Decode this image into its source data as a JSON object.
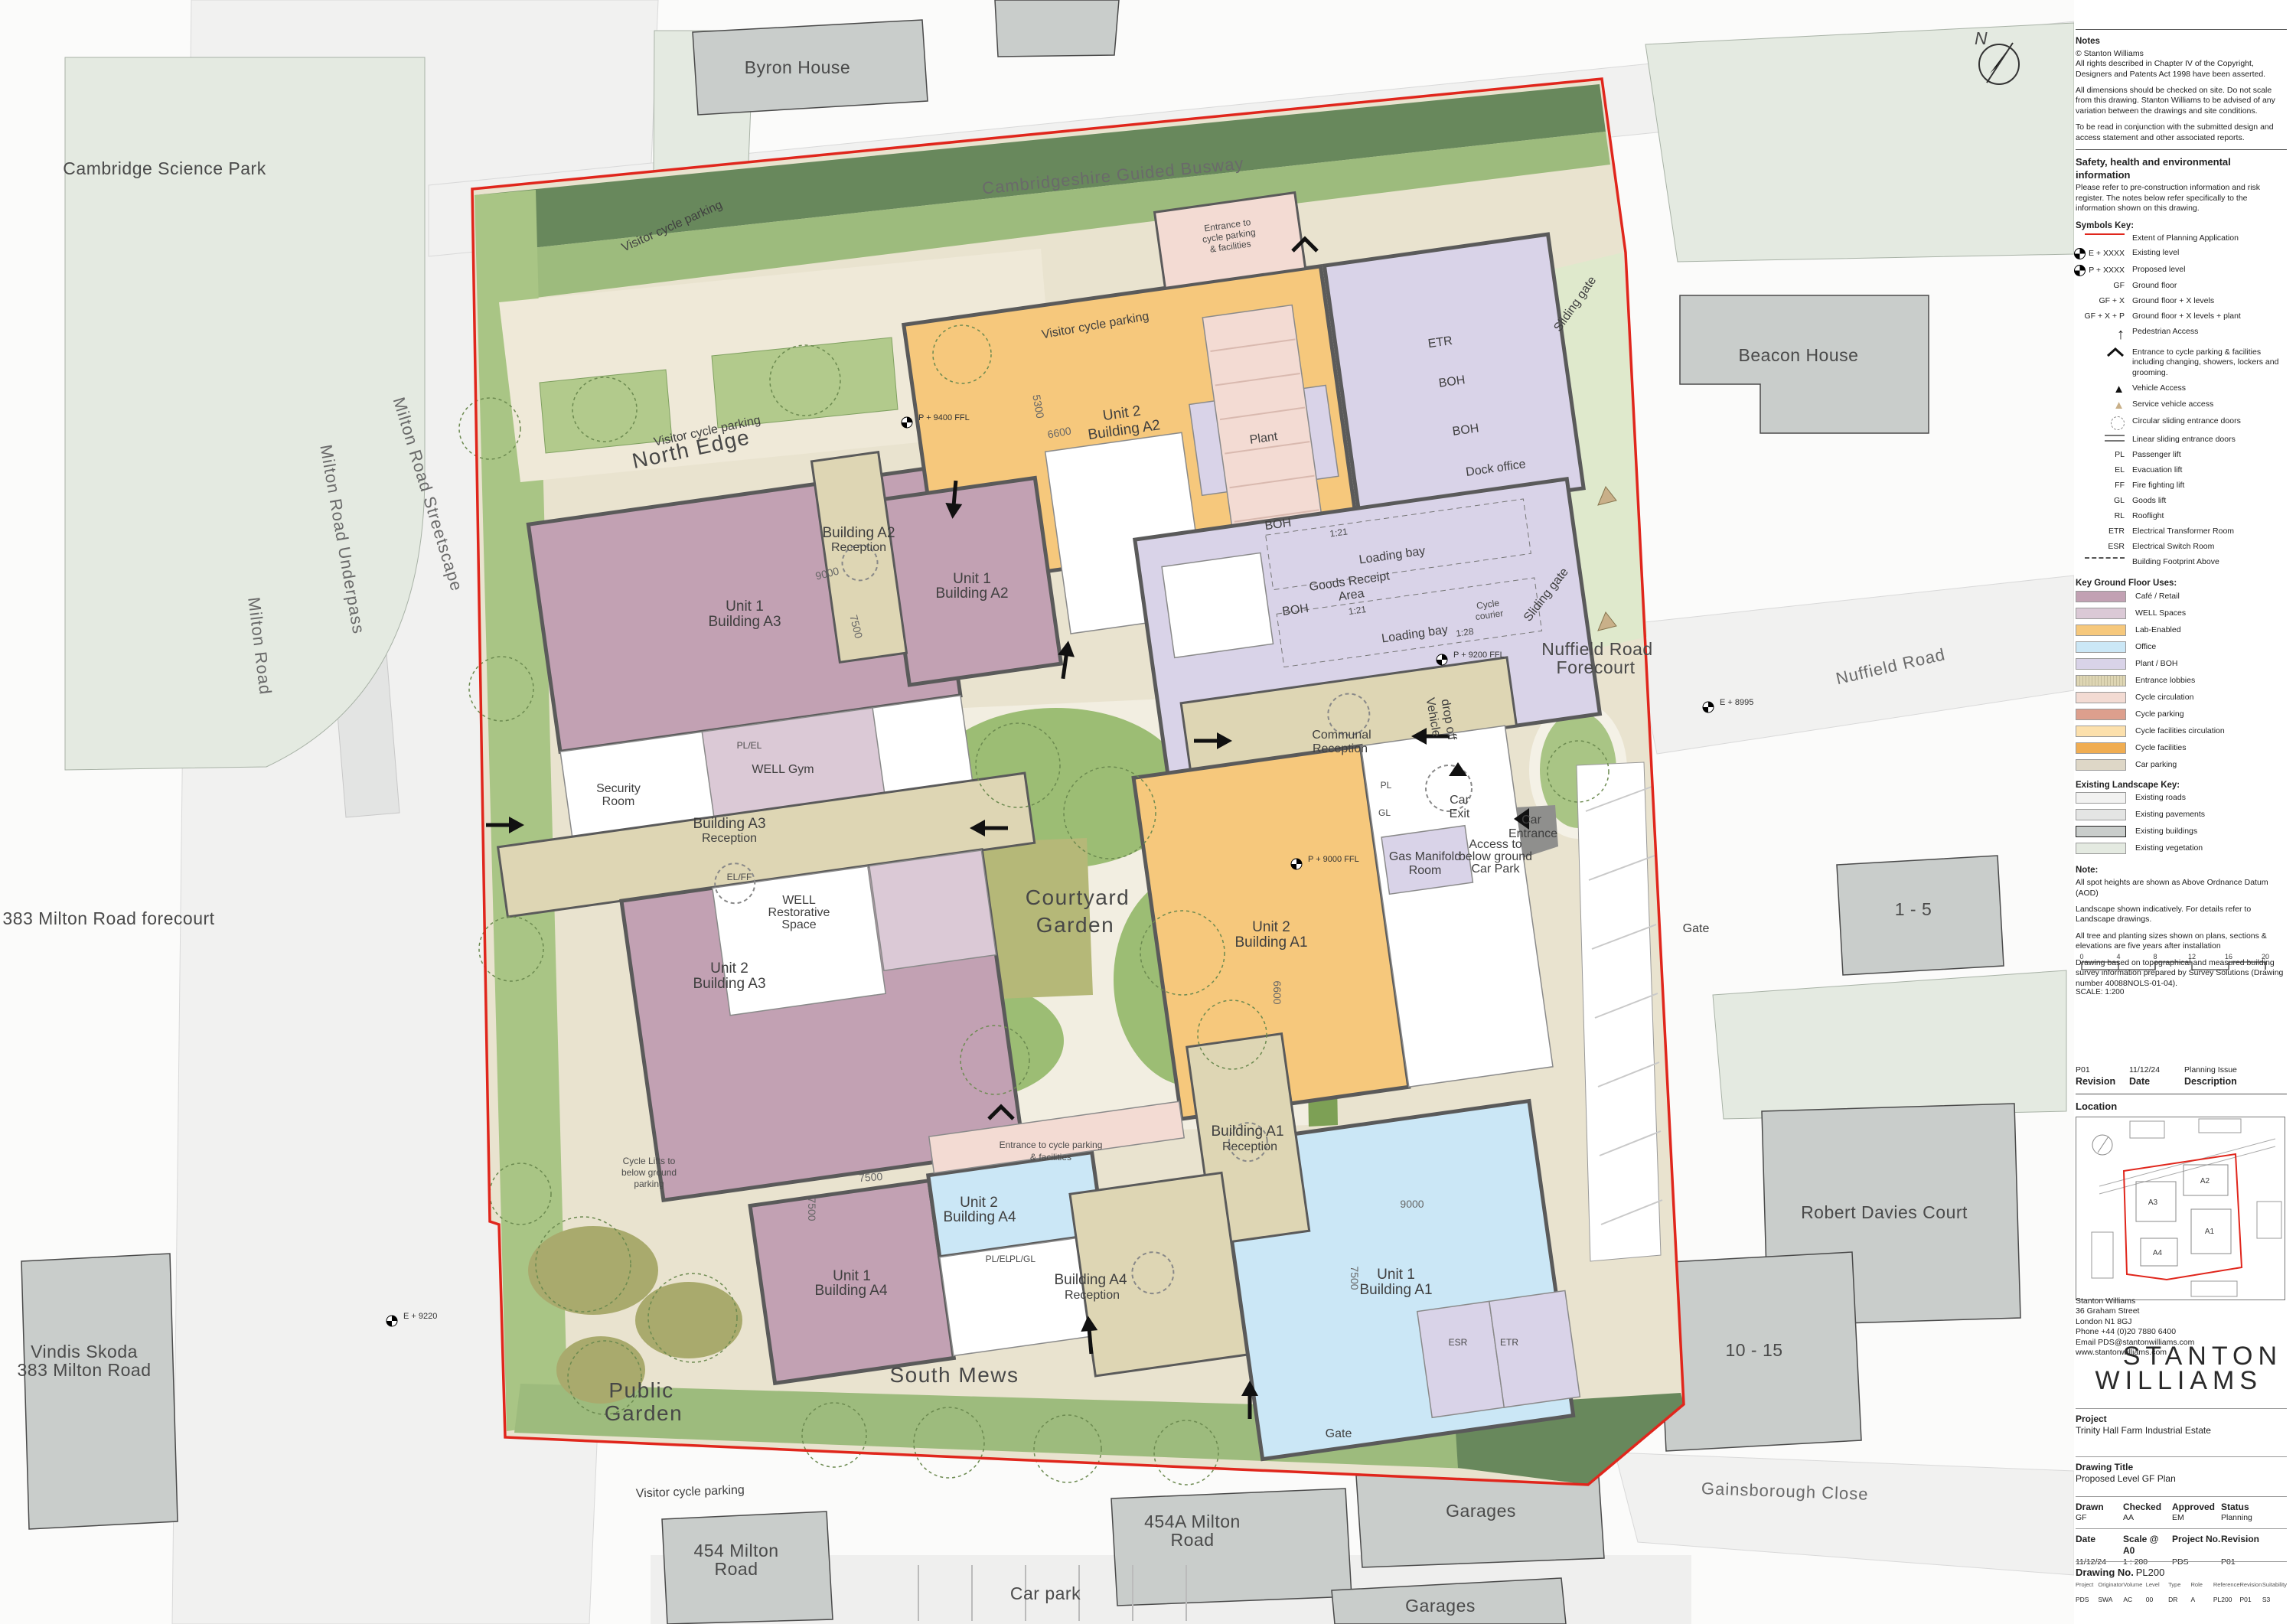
{
  "plan": {
    "labels": {
      "cambridge_science_park": "Cambridge Science Park",
      "byron_house": "Byron House",
      "guided_busway": "Cambridgeshire Guided Busway",
      "beacon_house": "Beacon House",
      "nuffield_road": "Nuffield Road",
      "one_to_five": "1 - 5",
      "robert_davies_court": "Robert Davies Court",
      "ten_to_fifteen": "10 - 15",
      "gainsborough_close": "Gainsborough Close",
      "garages": "Garages",
      "car_park": "Car park",
      "r454_1": "454 Milton",
      "r454_2": "Road",
      "r454a_1": "454A Milton",
      "r454a_2": "Road",
      "vindis_1": "Vindis Skoda",
      "vindis_2": "383 Milton Road",
      "forecourt383": "383 Milton Road forecourt",
      "milton_road": "Milton Road",
      "milton_underpass": "Milton Road Underpass",
      "milton_streetscape": "Milton Road Streetscape",
      "north_edge": "North Edge",
      "south_mews": "South Mews",
      "courtyard_1": "Courtyard",
      "courtyard_2": "Garden",
      "public_1": "Public",
      "public_2": "Garden",
      "nuffield_forecourt_2": "Forecourt",
      "communal": "Communal",
      "reception": "Reception",
      "building_a1": "Building A1",
      "building_a2": "Building A2",
      "building_a3": "Building A3",
      "building_a4": "Building A4",
      "unit1": "Unit 1",
      "unit2": "Unit 2",
      "well_gym": "WELL Gym",
      "security_1": "Security",
      "room": "Room",
      "well": "WELL",
      "restorative": "Restorative",
      "space": "Space",
      "cycle_lifts_1": "Cycle Lifts to",
      "below_ground": "below ground",
      "parking": "parking",
      "visitor_cycle_parking": "Visitor cycle parking",
      "ent_to": "Entrance to",
      "cycle_parking_l": "cycle parking",
      "amp_facilities": "& facilities",
      "entrance_cycle_l1": "Entrance to cycle parking",
      "plant": "Plant",
      "boh": "BOH",
      "etr": "ETR",
      "esr": "ESR",
      "dock_office": "Dock office",
      "loading_bay": "Loading bay",
      "goods_1": "Goods Receipt",
      "goods_2": "Area",
      "r121": "1:21",
      "r128": "1:28",
      "cycle_c1": "Cycle",
      "cycle_c2": "courier",
      "sliding_gate": "Sliding gate",
      "vehicle": "Vehicle",
      "drop_off": "drop off",
      "car": "Car",
      "exit": "Exit",
      "entrance": "Entrance",
      "access_1": "Access to",
      "car_park_cap": "Car Park",
      "gas_manifold": "Gas Manifold",
      "gate": "Gate",
      "pl_el": "PL/EL",
      "el_ff": "EL/FF",
      "pl_gl": "PL/GL",
      "pl": "PL",
      "gl": "GL",
      "d9000": "9000",
      "d7500": "7500",
      "d6600": "6600",
      "d5300": "5300",
      "sp1": "P + 9400 FFL",
      "sp2": "P + 9200 FFL",
      "sp3": "P + 9000 FFL",
      "sp4": "E + 8995",
      "sp5": "E + 9220",
      "north_n": "N"
    }
  },
  "panel": {
    "notes_title": "Notes",
    "notes_paras": [
      "© Stanton Williams\nAll rights described in Chapter IV of the Copyright, Designers and Patents Act 1998 have been asserted.",
      "All dimensions should be checked on site. Do not scale from this drawing. Stanton Williams to be advised of any variation between the drawings and site conditions.",
      "To be read in conjunction with the submitted design and access statement and other associated reports."
    ],
    "she_title": "Safety, health and environmental information",
    "she_text": "Please refer to pre-construction information and risk register. The notes below refer specifically to the information shown on this drawing.",
    "symbols_title": "Symbols Key:",
    "symbols": [
      {
        "sym": "",
        "label": "Extent of Planning Application"
      },
      {
        "sym": "E + XXXX",
        "label": "Existing level"
      },
      {
        "sym": "P + XXXX",
        "label": "Proposed level"
      },
      {
        "sym": "GF",
        "label": "Ground floor"
      },
      {
        "sym": "GF + X",
        "label": "Ground floor + X levels"
      },
      {
        "sym": "GF + X + P",
        "label": "Ground floor + X levels + plant"
      },
      {
        "sym": "",
        "label": "Pedestrian Access"
      },
      {
        "sym": "",
        "label": "Entrance to cycle parking & facilities including changing, showers, lockers and grooming."
      },
      {
        "sym": "",
        "label": "Vehicle Access"
      },
      {
        "sym": "",
        "label": "Service vehicle access"
      },
      {
        "sym": "",
        "label": "Circular sliding entrance doors"
      },
      {
        "sym": "",
        "label": "Linear sliding entrance doors"
      },
      {
        "sym": "PL",
        "label": "Passenger lift"
      },
      {
        "sym": "EL",
        "label": "Evacuation lift"
      },
      {
        "sym": "FF",
        "label": "Fire fighting lift"
      },
      {
        "sym": "GL",
        "label": "Goods lift"
      },
      {
        "sym": "RL",
        "label": "Rooflight"
      },
      {
        "sym": "ETR",
        "label": "Electrical Transformer Room"
      },
      {
        "sym": "ESR",
        "label": "Electrical Switch Room"
      },
      {
        "sym": "",
        "label": "Building Footprint Above"
      }
    ],
    "uses_title": "Key Ground Floor Uses:",
    "uses": [
      {
        "label": "Café / Retail",
        "color": "#c2a1b3"
      },
      {
        "label": "WELL Spaces",
        "color": "#dbc9d6"
      },
      {
        "label": "Lab-Enabled",
        "color": "#f6c87c"
      },
      {
        "label": "Office",
        "color": "#cbe7f6"
      },
      {
        "label": "Plant / BOH",
        "color": "#d9d3e8"
      },
      {
        "label": "Entrance lobbies",
        "color": "#ded6b4"
      },
      {
        "label": "Cycle circulation",
        "color": "#f3dbd3"
      },
      {
        "label": "Cycle parking",
        "color": "#dd9f8d"
      },
      {
        "label": "Cycle facilities circulation",
        "color": "#fce0ac"
      },
      {
        "label": "Cycle facilities",
        "color": "#f0ad52"
      },
      {
        "label": "Car parking",
        "color": "#ded7c7"
      }
    ],
    "landscape_title": "Existing Landscape Key:",
    "landscape": [
      {
        "label": "Existing roads",
        "color": "#f2f2f1"
      },
      {
        "label": "Existing pavements",
        "color": "#e4e5e4"
      },
      {
        "label": "Existing buildings",
        "color": "#c9cdcb"
      },
      {
        "label": "Existing vegetation",
        "color": "#e4eae1"
      }
    ],
    "note_title": "Note:",
    "note_paras": [
      "All spot heights are shown as Above Ordnance Datum (AOD)",
      "Landscape shown indicatively. For details refer to Landscape drawings.",
      "All tree and planting sizes shown on plans, sections & elevations are five years after installation",
      "Drawing based on topographical and measured building survey information prepared by Survey Solutions (Drawing number 40088NOLS-01-04)."
    ],
    "scale": {
      "ticks": [
        "0",
        "4",
        "8",
        "12",
        "16",
        "20"
      ],
      "caption": "SCALE: 1:200"
    },
    "revision_row": {
      "rev": "P01",
      "date": "11/12/24",
      "desc": "Planning Issue"
    },
    "revision_headers": {
      "rev": "Revision",
      "date": "Date",
      "desc": "Description"
    },
    "location_title": "Location",
    "location_buildings": [
      "A3",
      "A2",
      "A1",
      "A4"
    ],
    "address": "Stanton Williams\n36 Graham Street\nLondon N1 8GJ\nPhone +44 (0)20 7880 6400\nEmail PDS@stantonwilliams.com\nwww.stantonwilliams.com",
    "logo1": "STANTON",
    "logo2": "WILLIAMS",
    "project_label": "Project",
    "project": "Trinity Hall Farm Industrial Estate",
    "drawing_title_label": "Drawing Title",
    "drawing_title": "Proposed Level GF Plan",
    "meta1_h": {
      "drawn": "Drawn",
      "checked": "Checked",
      "approved": "Approved",
      "status": "Status"
    },
    "meta1_v": {
      "drawn": "GF",
      "checked": "AA",
      "approved": "EM",
      "status": "Planning"
    },
    "meta2_h": {
      "date": "Date",
      "scale": "Scale @ A0",
      "project_no": "Project No.",
      "revision": "Revision"
    },
    "meta2_v": {
      "date": "11/12/24",
      "scale": "1 : 200",
      "project_no": "PDS",
      "revision": "P01"
    },
    "drawing_no_label": "Drawing No.",
    "drawing_no": "PL200",
    "codes": [
      {
        "h": "Project",
        "v": "PDS"
      },
      {
        "h": "Originator",
        "v": "SWA"
      },
      {
        "h": "Volume",
        "v": "AC"
      },
      {
        "h": "Level",
        "v": "00"
      },
      {
        "h": "Type",
        "v": "DR"
      },
      {
        "h": "Role",
        "v": "A"
      },
      {
        "h": "Reference",
        "v": "PL200"
      },
      {
        "h": "Revision",
        "v": "P01"
      },
      {
        "h": "Suitability",
        "v": "S3"
      }
    ],
    "colors": {
      "boundary": "#e0261c"
    }
  }
}
